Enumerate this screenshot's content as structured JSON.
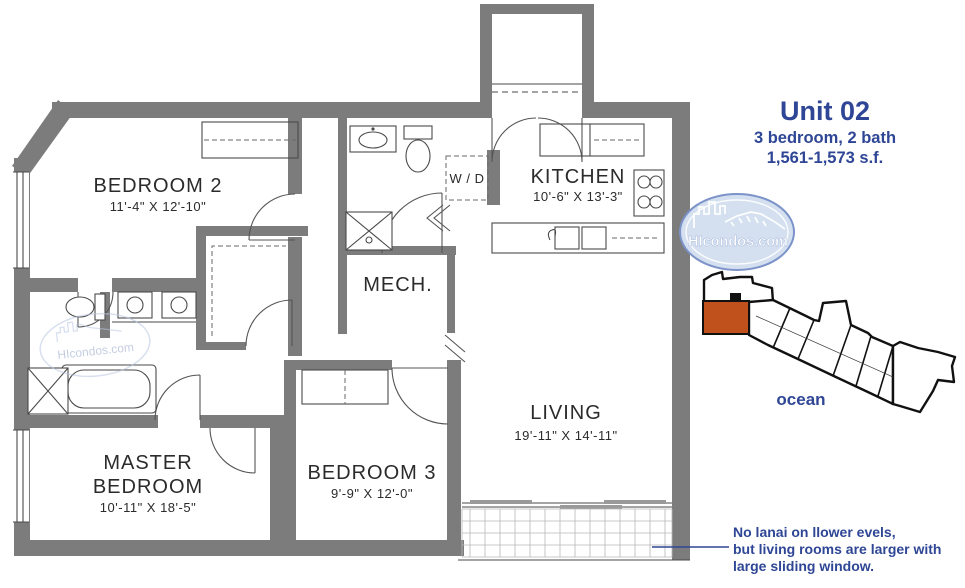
{
  "title": {
    "unit": "Unit 02",
    "specs": "3 bedroom, 2 bath",
    "size": "1,561-1,573 s.f."
  },
  "rooms": {
    "bedroom2": {
      "name": "BEDROOM 2",
      "dims": "11'-4\" X 12'-10\""
    },
    "kitchen": {
      "name": "KITCHEN",
      "dims": "10'-6\" X 13'-3\""
    },
    "wd": {
      "label": "W / D"
    },
    "mech": {
      "name": "MECH."
    },
    "master": {
      "name_line1": "MASTER",
      "name_line2": "BEDROOM",
      "dims": "10'-11\" X 18'-5\""
    },
    "bedroom3": {
      "name": "BEDROOM 3",
      "dims": "9'-9\" X 12'-0\""
    },
    "living": {
      "name": "LIVING",
      "dims": "19'-11\" X 14'-11\""
    }
  },
  "logo": {
    "text": "HIcondos.com"
  },
  "watermark": {
    "text": "HIcondos.com"
  },
  "locator": {
    "ocean_label": "ocean",
    "highlight_color": "#c0511d"
  },
  "note": {
    "line1": "No lanai on llower evels,",
    "line2": "but living rooms are larger with",
    "line3": "large sliding window."
  },
  "colors": {
    "accent_blue": "#2e4695",
    "wall_gray": "#7c7c7c",
    "unit_orange": "#c0511d"
  }
}
